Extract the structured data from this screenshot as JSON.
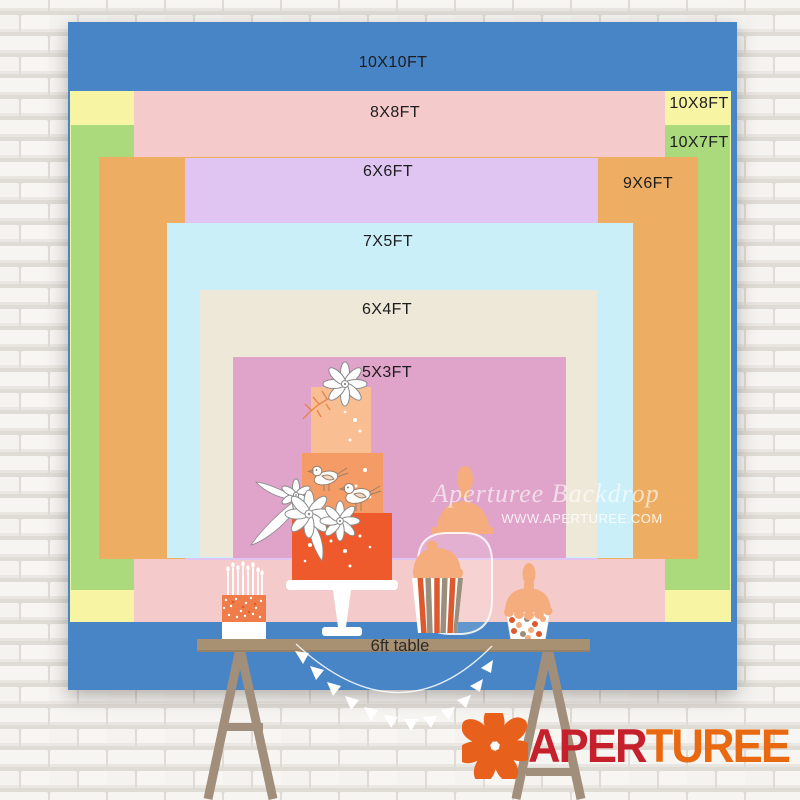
{
  "size_chart": {
    "rects": [
      {
        "label": "10X10FT",
        "size_ft": "10x10",
        "color": "#4785C6"
      },
      {
        "label": "8X8FT",
        "size_ft": "8x8",
        "color": "#F5CACB"
      },
      {
        "label": "10X8FT",
        "size_ft": "10x8",
        "color": "#F7F5A3"
      },
      {
        "label": "10X7FT",
        "size_ft": "10x7",
        "color": "#ABDA7C"
      },
      {
        "label": "6X6FT",
        "size_ft": "6x6",
        "color": "#E0C5F3"
      },
      {
        "label": "9X6FT",
        "size_ft": "9x6",
        "color": "#EDAE64"
      },
      {
        "label": "7X5FT",
        "size_ft": "7x5",
        "color": "#CAEFF9"
      },
      {
        "label": "6X4FT",
        "size_ft": "6x4",
        "color": "#EEE8D8"
      },
      {
        "label": "5X3FT",
        "size_ft": "5x3",
        "color": "#E0A3C9"
      }
    ],
    "table_label": "6ft table"
  },
  "watermark": {
    "line1": "Aperturee Backdrop",
    "line2": "WWW.APERTUREE.COM"
  },
  "logo": {
    "icon": "aperture",
    "part1": "APER",
    "part2": "TUREE",
    "color1": "#C5202B",
    "color2": "#E8690F"
  }
}
